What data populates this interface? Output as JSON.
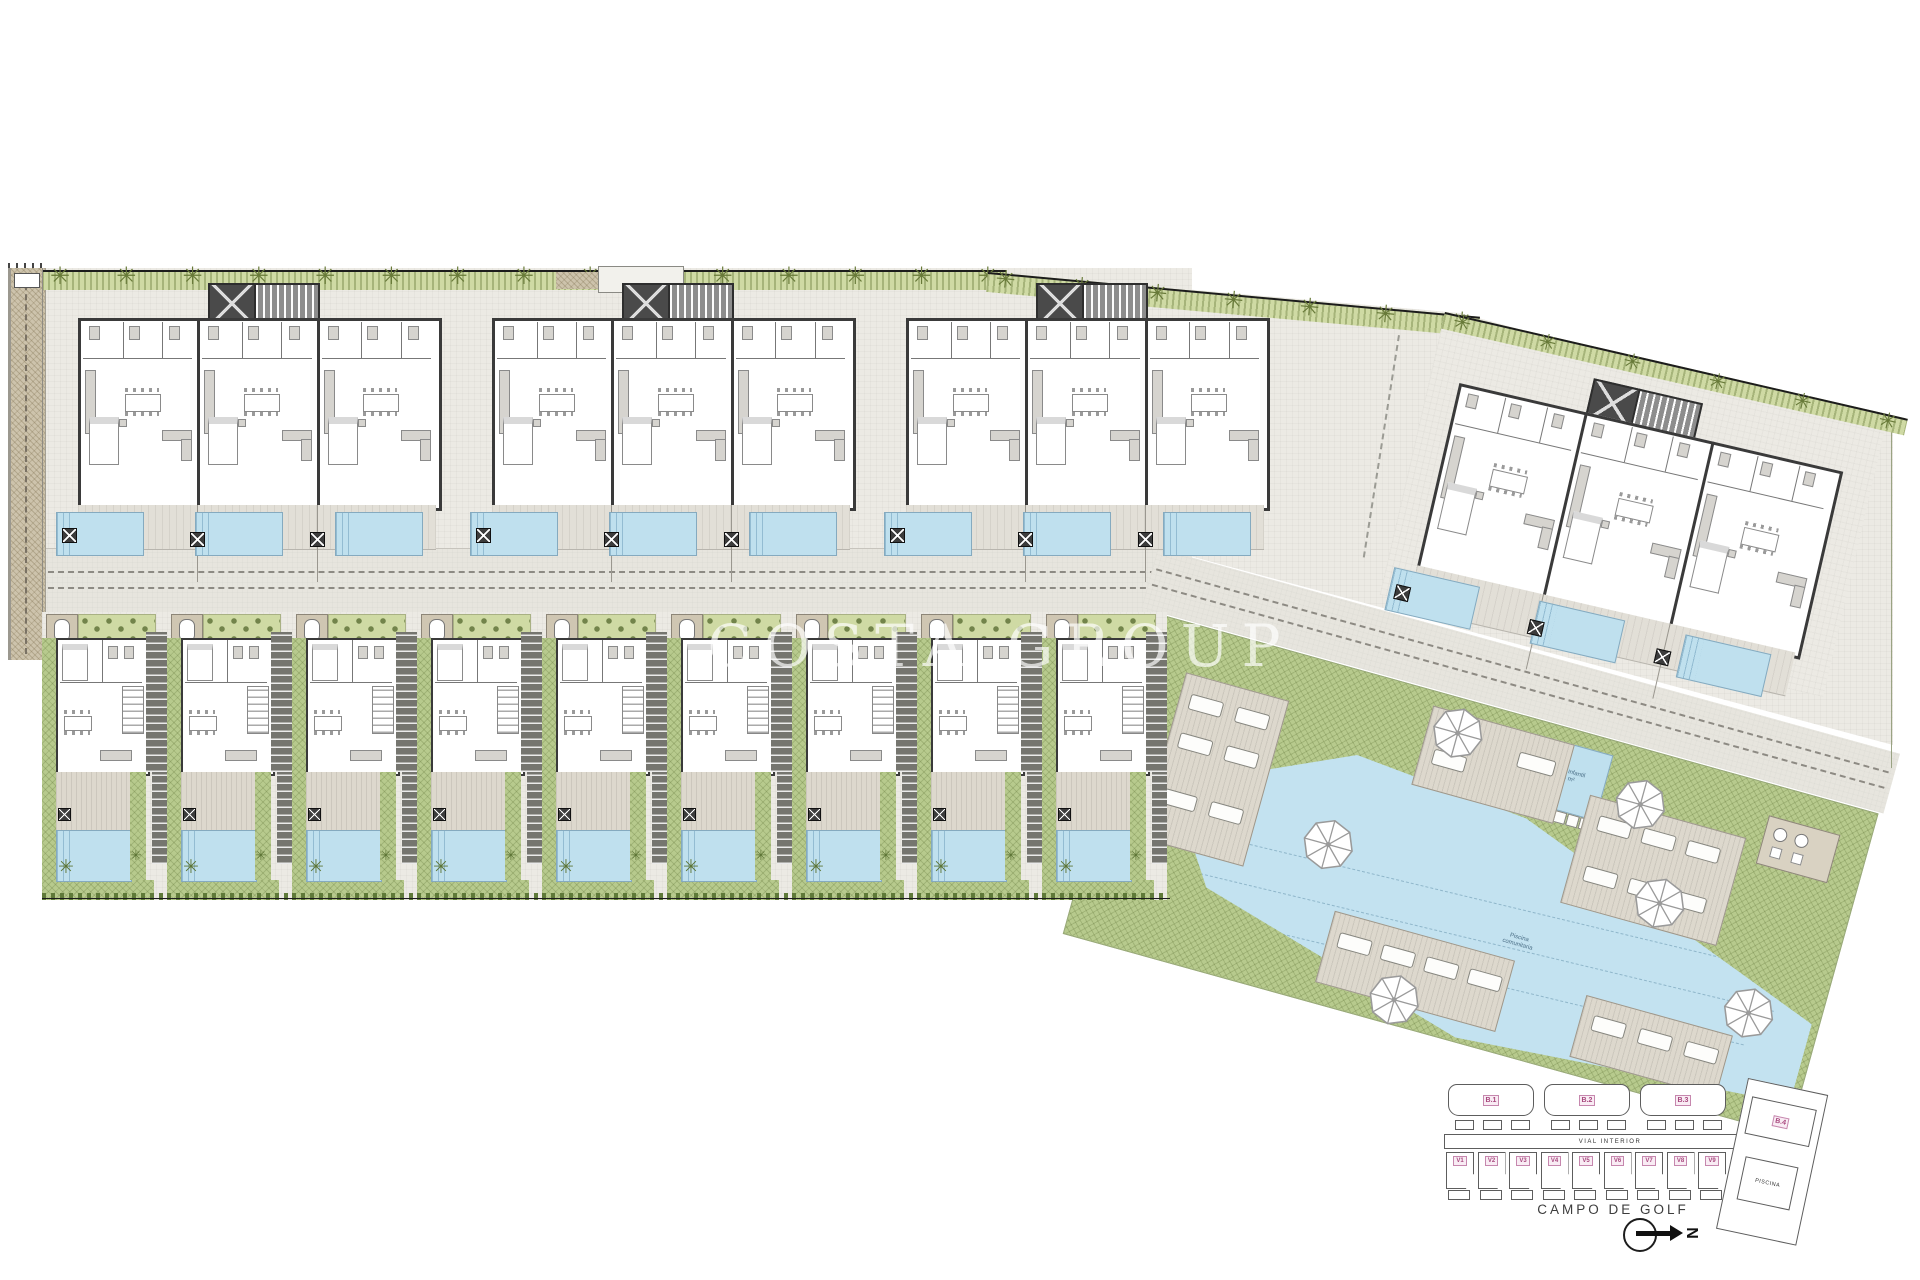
{
  "plan": {
    "watermark": "COSTA GROUP",
    "buildings": {
      "blocks": [
        {
          "label": "B.1",
          "units": 3,
          "pools": 3
        },
        {
          "label": "B.2",
          "units": 3,
          "pools": 3
        },
        {
          "label": "B.3",
          "units": 3,
          "pools": 3
        },
        {
          "label": "B.4",
          "units": 3,
          "pools": 3
        }
      ]
    },
    "villas": {
      "labels": [
        "V1",
        "V2",
        "V3",
        "V4",
        "V5",
        "V6",
        "V7",
        "V8",
        "V9"
      ],
      "count": 9
    },
    "amenities": {
      "kids_pool_label": "Piscina infantil",
      "kids_pool_area": "12.5 m²",
      "main_pool_label": "Piscina",
      "main_pool_sublabel": "comunitaria",
      "umbrella_count": 6
    },
    "colors": {
      "paving": "#eceae4",
      "road": "#e7e5de",
      "lawn": "#b7ca8d",
      "hedge": "#cfdaa4",
      "tree": "#687a39",
      "pool_water": "#bfe0ee",
      "wall": "#3a3a3a",
      "dirt": "#cdc3ac",
      "label_pink": "#a8487e"
    }
  },
  "keyplan": {
    "blocks_row": [
      "B.1",
      "B.2",
      "B.3"
    ],
    "villas_row": [
      "V1",
      "V2",
      "V3",
      "V4",
      "V5",
      "V6",
      "V7",
      "V8",
      "V9"
    ],
    "right_block": "B.4",
    "right_pool_label": "PISCINA",
    "road_label": "VIAL INTERIOR",
    "golf_label": "CAMPO DE GOLF",
    "north_label": "N"
  }
}
